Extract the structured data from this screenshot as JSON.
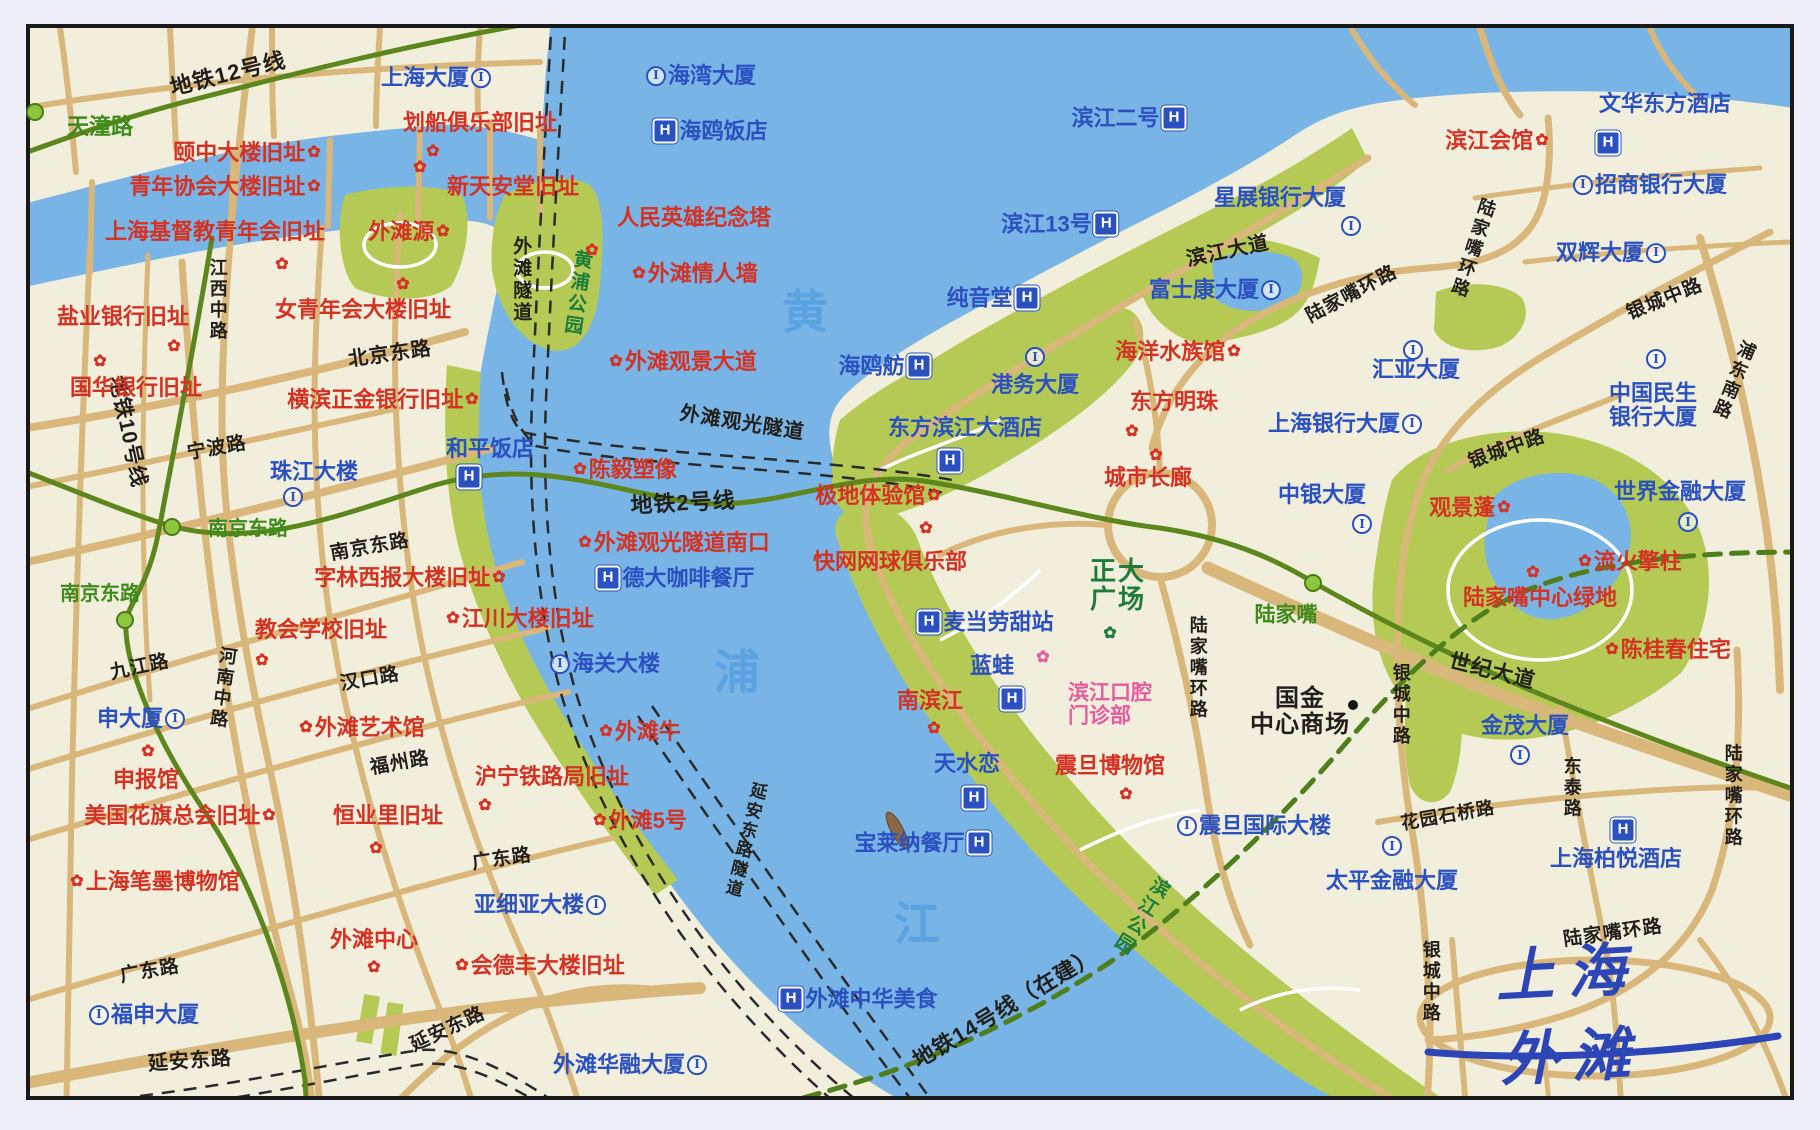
{
  "title": "上海外滩",
  "palette": {
    "paper": "#edeef8",
    "land": "#f2eedc",
    "water": "#78b4e6",
    "parkfill": "#b5ca55",
    "road": "#d9b77b",
    "metro": "#5d861c",
    "metro14": "#4f7f1d",
    "frame": "#191919",
    "her": "#d43223",
    "bld": "#2b51c0",
    "st": "#221f1a",
    "grn": "#3e8a1a",
    "parktext": "#1d7c3a",
    "pink": "#e75a9f",
    "riv": "#5aa2e0",
    "title": "#2c46b8",
    "tunnel": "#2a2a2a"
  },
  "map": {
    "labels": [
      {
        "t": "地铁12号线",
        "x": 228,
        "y": 74,
        "c": "st",
        "r": -14,
        "fs": 22,
        "n": "metro-line-12-label"
      },
      {
        "t": "地铁10号线",
        "x": 127,
        "y": 432,
        "c": "st",
        "r": 78,
        "fs": 21,
        "n": "metro-line-10-label"
      },
      {
        "t": "地铁2号线",
        "x": 683,
        "y": 503,
        "c": "st",
        "r": -3,
        "fs": 22,
        "n": "metro-line-2-label"
      },
      {
        "t": "地铁14号线（在建）",
        "x": 1005,
        "y": 1008,
        "c": "st",
        "r": -31,
        "fs": 22,
        "n": "metro-line-14-label"
      },
      {
        "t": "外滩隧道",
        "x": 520,
        "y": 280,
        "c": "st",
        "v": true,
        "fs": 19,
        "n": "bund-tunnel-label"
      },
      {
        "t": "外滩观光隧道",
        "x": 742,
        "y": 424,
        "c": "st",
        "r": 9,
        "fs": 20,
        "n": "sightseeing-tunnel-label"
      },
      {
        "t": "延安东路隧道",
        "x": 744,
        "y": 840,
        "c": "st",
        "v": true,
        "r": 14,
        "fs": 17,
        "n": "yanan-tunnel-label"
      },
      {
        "t": "天潼路",
        "x": 100,
        "y": 127,
        "c": "grn",
        "fs": 22
      },
      {
        "t": "江西中路",
        "x": 217,
        "y": 300,
        "c": "st",
        "v": true,
        "fs": 18
      },
      {
        "t": "北京东路",
        "x": 390,
        "y": 355,
        "c": "st",
        "r": -8,
        "fs": 20
      },
      {
        "t": "宁波路",
        "x": 217,
        "y": 449,
        "c": "st",
        "r": -10
      },
      {
        "t": "南京东路",
        "x": 370,
        "y": 548,
        "c": "st",
        "r": -10
      },
      {
        "t": "南京东路",
        "x": 248,
        "y": 530,
        "c": "grn"
      },
      {
        "t": "南京东路",
        "x": 100,
        "y": 595,
        "c": "grn"
      },
      {
        "t": "九江路",
        "x": 140,
        "y": 668,
        "c": "st",
        "r": -12
      },
      {
        "t": "河南中路",
        "x": 222,
        "y": 688,
        "c": "st",
        "v": true,
        "r": 8,
        "fs": 18
      },
      {
        "t": "汉口路",
        "x": 370,
        "y": 680,
        "c": "st",
        "r": -10
      },
      {
        "t": "福州路",
        "x": 400,
        "y": 764,
        "c": "st",
        "r": -10
      },
      {
        "t": "广东路",
        "x": 150,
        "y": 972,
        "c": "st",
        "r": -10
      },
      {
        "t": "广东路",
        "x": 502,
        "y": 860,
        "c": "st",
        "r": -8
      },
      {
        "t": "延安东路",
        "x": 190,
        "y": 1062,
        "c": "st",
        "r": -4,
        "fs": 20
      },
      {
        "t": "延安东路",
        "x": 448,
        "y": 1030,
        "c": "st",
        "r": -25
      },
      {
        "t": "滨江大道",
        "x": 1228,
        "y": 252,
        "c": "st",
        "r": -12,
        "fs": 20
      },
      {
        "t": "陆家嘴环路",
        "x": 1352,
        "y": 295,
        "c": "st",
        "r": -28
      },
      {
        "t": "陆家嘴环路",
        "x": 1472,
        "y": 248,
        "c": "st",
        "v": true,
        "r": 18,
        "fs": 18
      },
      {
        "t": "陆家嘴环路",
        "x": 1197,
        "y": 668,
        "c": "st",
        "v": true,
        "fs": 18
      },
      {
        "t": "陆家嘴环路",
        "x": 1732,
        "y": 796,
        "c": "st",
        "v": true,
        "fs": 18
      },
      {
        "t": "陆家嘴环路",
        "x": 1613,
        "y": 934,
        "c": "st",
        "r": -8
      },
      {
        "t": "银城中路",
        "x": 1665,
        "y": 300,
        "c": "st",
        "r": -22
      },
      {
        "t": "银城中路",
        "x": 1507,
        "y": 450,
        "c": "st",
        "r": -20
      },
      {
        "t": "银城中路",
        "x": 1400,
        "y": 705,
        "c": "st",
        "v": true,
        "fs": 18
      },
      {
        "t": "银城中路",
        "x": 1430,
        "y": 982,
        "c": "st",
        "v": true,
        "fs": 18
      },
      {
        "t": "浦东南路",
        "x": 1733,
        "y": 380,
        "c": "st",
        "v": true,
        "r": 22,
        "fs": 18
      },
      {
        "t": "世纪大道",
        "x": 1492,
        "y": 672,
        "c": "st",
        "r": 14,
        "fs": 21
      },
      {
        "t": "东泰路",
        "x": 1571,
        "y": 788,
        "c": "st",
        "v": true,
        "fs": 18
      },
      {
        "t": "花园石桥路",
        "x": 1448,
        "y": 816,
        "c": "st",
        "r": -10,
        "fs": 18
      },
      {
        "t": "国金\n中心商场",
        "x": 1300,
        "y": 712,
        "c": "st",
        "fs": 24
      },
      {
        "t": "黄",
        "x": 805,
        "y": 313,
        "c": "riv",
        "n": "river-name-char"
      },
      {
        "t": "浦",
        "x": 737,
        "y": 673,
        "c": "riv",
        "n": "river-name-char"
      },
      {
        "t": "江",
        "x": 917,
        "y": 925,
        "c": "riv",
        "n": "river-name-char"
      },
      {
        "t": "黄浦公园",
        "x": 576,
        "y": 293,
        "c": "park",
        "v": true,
        "r": 8,
        "fs": 19
      },
      {
        "t": "滨江公园",
        "x": 1140,
        "y": 915,
        "c": "park",
        "v": true,
        "r": 32,
        "fs": 19
      },
      {
        "t": "正大\n广场",
        "x": 1118,
        "y": 585,
        "c": "park",
        "fs": 26
      },
      {
        "t": "陆家嘴",
        "x": 1286,
        "y": 616,
        "c": "grn",
        "fs": 21
      },
      {
        "t": "颐中大楼旧址",
        "x": 247,
        "y": 153,
        "c": "her",
        "post": "f"
      },
      {
        "t": "划船俱乐部旧址",
        "x": 480,
        "y": 123,
        "c": "her"
      },
      {
        "t": "青年协会大楼旧址",
        "x": 225,
        "y": 187,
        "c": "her",
        "post": "f"
      },
      {
        "t": "上海基督教青年会旧址",
        "x": 215,
        "y": 232,
        "c": "her"
      },
      {
        "t": "新天安堂旧址",
        "x": 513,
        "y": 187,
        "c": "her"
      },
      {
        "t": "外滩源",
        "x": 409,
        "y": 232,
        "c": "her",
        "post": "f"
      },
      {
        "t": "人民英雄纪念塔",
        "x": 694,
        "y": 218,
        "c": "her"
      },
      {
        "t": "外滩情人墙",
        "x": 695,
        "y": 274,
        "c": "her",
        "pre": "f"
      },
      {
        "t": "盐业银行旧址",
        "x": 123,
        "y": 317,
        "c": "her"
      },
      {
        "t": "国华银行旧址",
        "x": 136,
        "y": 388,
        "c": "her"
      },
      {
        "t": "女青年会大楼旧址",
        "x": 363,
        "y": 310,
        "c": "her"
      },
      {
        "t": "横滨正金银行旧址",
        "x": 383,
        "y": 400,
        "c": "her",
        "post": "f"
      },
      {
        "t": "外滩观景大道",
        "x": 683,
        "y": 362,
        "c": "her",
        "pre": "f"
      },
      {
        "t": "陈毅塑像",
        "x": 625,
        "y": 470,
        "c": "her",
        "pre": "f"
      },
      {
        "t": "外滩观光隧道南口",
        "x": 674,
        "y": 543,
        "c": "her",
        "pre": "f"
      },
      {
        "t": "字林西报大楼旧址",
        "x": 410,
        "y": 578,
        "c": "her",
        "post": "f"
      },
      {
        "t": "教会学校旧址",
        "x": 321,
        "y": 630,
        "c": "her"
      },
      {
        "t": "江川大楼旧址",
        "x": 520,
        "y": 619,
        "c": "her",
        "pre": "f"
      },
      {
        "t": "外滩艺术馆",
        "x": 362,
        "y": 728,
        "c": "her",
        "pre": "f"
      },
      {
        "t": "申报馆",
        "x": 146,
        "y": 780,
        "c": "her"
      },
      {
        "t": "美国花旗总会旧址",
        "x": 180,
        "y": 816,
        "c": "her",
        "post": "f"
      },
      {
        "t": "恒业里旧址",
        "x": 388,
        "y": 816,
        "c": "her"
      },
      {
        "t": "沪宁铁路局旧址",
        "x": 552,
        "y": 777,
        "c": "her"
      },
      {
        "t": "外滩牛",
        "x": 640,
        "y": 732,
        "c": "her",
        "pre": "f"
      },
      {
        "t": "外滩5号",
        "x": 640,
        "y": 821,
        "c": "her",
        "pre": "f"
      },
      {
        "t": "上海笔墨博物馆",
        "x": 155,
        "y": 882,
        "c": "her",
        "pre": "f"
      },
      {
        "t": "外滩中心",
        "x": 374,
        "y": 940,
        "c": "her"
      },
      {
        "t": "会德丰大楼旧址",
        "x": 540,
        "y": 966,
        "c": "her",
        "pre": "f"
      },
      {
        "t": "极地体验馆",
        "x": 878,
        "y": 496,
        "c": "her",
        "post": "f"
      },
      {
        "t": "快网网球俱乐部",
        "x": 890,
        "y": 562,
        "c": "her"
      },
      {
        "t": "城市长廊",
        "x": 1148,
        "y": 478,
        "c": "her"
      },
      {
        "t": "海洋水族馆",
        "x": 1178,
        "y": 352,
        "c": "her",
        "post": "f"
      },
      {
        "t": "东方明珠",
        "x": 1174,
        "y": 402,
        "c": "her"
      },
      {
        "t": "观景蓬",
        "x": 1470,
        "y": 508,
        "c": "her",
        "post": "f"
      },
      {
        "t": "流火擎柱",
        "x": 1630,
        "y": 562,
        "c": "her",
        "pre": "f"
      },
      {
        "t": "陆家嘴中心绿地",
        "x": 1540,
        "y": 598,
        "c": "her"
      },
      {
        "t": "陈桂春住宅",
        "x": 1668,
        "y": 650,
        "c": "her",
        "pre": "f"
      },
      {
        "t": "震旦博物馆",
        "x": 1110,
        "y": 766,
        "c": "her"
      },
      {
        "t": "南滨江",
        "x": 930,
        "y": 701,
        "c": "her"
      },
      {
        "t": "滨江会馆",
        "x": 1497,
        "y": 141,
        "c": "her",
        "post": "f"
      },
      {
        "t": "上海大厦",
        "x": 436,
        "y": 78,
        "c": "bld",
        "post": "i"
      },
      {
        "t": "海湾大厦",
        "x": 701,
        "y": 76,
        "c": "bld",
        "pre": "i"
      },
      {
        "t": "海鸥饭店",
        "x": 710,
        "y": 131,
        "c": "bld",
        "pre": "h"
      },
      {
        "t": "滨江二号",
        "x": 1129,
        "y": 118,
        "c": "bld",
        "post": "h"
      },
      {
        "t": "文华东方酒店",
        "x": 1665,
        "y": 104,
        "c": "bld"
      },
      {
        "t": "招商银行大厦",
        "x": 1650,
        "y": 185,
        "c": "bld",
        "pre": "i"
      },
      {
        "t": "双辉大厦",
        "x": 1611,
        "y": 253,
        "c": "bld",
        "post": "i"
      },
      {
        "t": "星展银行大厦",
        "x": 1280,
        "y": 198,
        "c": "bld"
      },
      {
        "t": "滨江13号",
        "x": 1060,
        "y": 224,
        "c": "bld",
        "post": "h"
      },
      {
        "t": "纯音堂",
        "x": 993,
        "y": 298,
        "c": "bld",
        "post": "h"
      },
      {
        "t": "富士康大厦",
        "x": 1215,
        "y": 290,
        "c": "bld",
        "post": "i"
      },
      {
        "t": "海鸥舫",
        "x": 885,
        "y": 366,
        "c": "bld",
        "post": "h"
      },
      {
        "t": "港务大厦",
        "x": 1035,
        "y": 385,
        "c": "bld"
      },
      {
        "t": "东方滨江大酒店",
        "x": 965,
        "y": 428,
        "c": "bld"
      },
      {
        "t": "上海银行大厦",
        "x": 1345,
        "y": 424,
        "c": "bld",
        "post": "i"
      },
      {
        "t": "汇亚大厦",
        "x": 1416,
        "y": 370,
        "c": "bld"
      },
      {
        "t": "中银大厦",
        "x": 1322,
        "y": 495,
        "c": "bld"
      },
      {
        "t": "中国民生\n银行大厦",
        "x": 1653,
        "y": 405,
        "c": "bld"
      },
      {
        "t": "世界金融大厦",
        "x": 1680,
        "y": 492,
        "c": "bld"
      },
      {
        "t": "珠江大楼",
        "x": 314,
        "y": 472,
        "c": "bld"
      },
      {
        "t": "和平饭店",
        "x": 490,
        "y": 449,
        "c": "bld"
      },
      {
        "t": "德大咖啡餐厅",
        "x": 675,
        "y": 578,
        "c": "bld",
        "pre": "h"
      },
      {
        "t": "海关大楼",
        "x": 605,
        "y": 664,
        "c": "bld",
        "pre": "i"
      },
      {
        "t": "申大厦",
        "x": 141,
        "y": 719,
        "c": "bld",
        "post": "i"
      },
      {
        "t": "福申大厦",
        "x": 144,
        "y": 1015,
        "c": "bld",
        "pre": "i"
      },
      {
        "t": "亚细亚大楼",
        "x": 540,
        "y": 905,
        "c": "bld",
        "post": "i"
      },
      {
        "t": "外滩华融大厦",
        "x": 630,
        "y": 1065,
        "c": "bld",
        "post": "i"
      },
      {
        "t": "外滩中华美食",
        "x": 858,
        "y": 999,
        "c": "bld",
        "pre": "h"
      },
      {
        "t": "宝莱纳餐厅",
        "x": 923,
        "y": 843,
        "c": "bld",
        "post": "h"
      },
      {
        "t": "天水恋",
        "x": 967,
        "y": 764,
        "c": "bld"
      },
      {
        "t": "蓝蛙",
        "x": 992,
        "y": 666,
        "c": "bld"
      },
      {
        "t": "麦当劳甜站",
        "x": 985,
        "y": 622,
        "c": "bld",
        "pre": "h"
      },
      {
        "t": "震旦国际大楼",
        "x": 1254,
        "y": 826,
        "c": "bld",
        "pre": "i"
      },
      {
        "t": "太平金融大厦",
        "x": 1392,
        "y": 881,
        "c": "bld"
      },
      {
        "t": "金茂大厦",
        "x": 1525,
        "y": 726,
        "c": "bld"
      },
      {
        "t": "上海柏悦酒店",
        "x": 1616,
        "y": 859,
        "c": "bld"
      },
      {
        "t": "滨江口腔\n门诊部",
        "x": 1110,
        "y": 705,
        "c": "pink"
      },
      {
        "x": 433,
        "y": 152,
        "c": "mk",
        "pre": "f"
      },
      {
        "x": 420,
        "y": 168,
        "c": "mk",
        "pre": "f"
      },
      {
        "x": 282,
        "y": 265,
        "c": "mk",
        "pre": "f"
      },
      {
        "x": 592,
        "y": 251,
        "c": "mk",
        "pre": "f"
      },
      {
        "x": 174,
        "y": 347,
        "c": "mk",
        "pre": "f"
      },
      {
        "x": 100,
        "y": 362,
        "c": "mk",
        "pre": "f"
      },
      {
        "x": 403,
        "y": 285,
        "c": "mk",
        "pre": "f"
      },
      {
        "x": 262,
        "y": 661,
        "c": "mk",
        "pre": "f"
      },
      {
        "x": 148,
        "y": 752,
        "c": "mk",
        "pre": "f"
      },
      {
        "x": 376,
        "y": 849,
        "c": "mk",
        "pre": "f"
      },
      {
        "x": 485,
        "y": 806,
        "c": "mk",
        "pre": "f"
      },
      {
        "x": 934,
        "y": 729,
        "c": "mk",
        "pre": "f"
      },
      {
        "x": 1126,
        "y": 795,
        "c": "mk",
        "pre": "f"
      },
      {
        "x": 1132,
        "y": 432,
        "c": "mk",
        "pre": "f"
      },
      {
        "x": 1156,
        "y": 456,
        "c": "mk",
        "pre": "f"
      },
      {
        "x": 374,
        "y": 968,
        "c": "mk",
        "pre": "f"
      },
      {
        "x": 926,
        "y": 529,
        "c": "mk",
        "pre": "f"
      },
      {
        "x": 1533,
        "y": 573,
        "c": "mk",
        "pre": "f"
      },
      {
        "x": 1608,
        "y": 143,
        "c": "mk",
        "pre": "h"
      },
      {
        "x": 950,
        "y": 461,
        "c": "mk",
        "pre": "h"
      },
      {
        "x": 469,
        "y": 477,
        "c": "mk",
        "pre": "h"
      },
      {
        "x": 974,
        "y": 798,
        "c": "mk",
        "pre": "h"
      },
      {
        "x": 1012,
        "y": 699,
        "c": "mk",
        "pre": "h"
      },
      {
        "x": 1623,
        "y": 830,
        "c": "mk",
        "pre": "h"
      },
      {
        "x": 1351,
        "y": 226,
        "c": "mk",
        "pre": "i"
      },
      {
        "x": 1035,
        "y": 357,
        "c": "mk",
        "pre": "i"
      },
      {
        "x": 1413,
        "y": 350,
        "c": "mk",
        "pre": "i"
      },
      {
        "x": 1362,
        "y": 524,
        "c": "mk",
        "pre": "i"
      },
      {
        "x": 1656,
        "y": 359,
        "c": "mk",
        "pre": "i"
      },
      {
        "x": 1688,
        "y": 522,
        "c": "mk",
        "pre": "i"
      },
      {
        "x": 293,
        "y": 497,
        "c": "mk",
        "pre": "i"
      },
      {
        "x": 1520,
        "y": 755,
        "c": "mk",
        "pre": "i"
      },
      {
        "x": 1392,
        "y": 846,
        "c": "mk",
        "pre": "i"
      },
      {
        "x": 35,
        "y": 112,
        "c": "mk",
        "pre": "gd"
      },
      {
        "x": 172,
        "y": 527,
        "c": "mk",
        "pre": "gd"
      },
      {
        "x": 125,
        "y": 620,
        "c": "mk",
        "pre": "gd"
      },
      {
        "x": 1313,
        "y": 583,
        "c": "mk",
        "pre": "gd"
      },
      {
        "x": 1353,
        "y": 705,
        "c": "mk",
        "pre": "bd"
      },
      {
        "x": 1043,
        "y": 658,
        "c": "mk",
        "pre": "fp"
      },
      {
        "x": 1110,
        "y": 634,
        "c": "mk",
        "pre": "fg"
      }
    ]
  }
}
